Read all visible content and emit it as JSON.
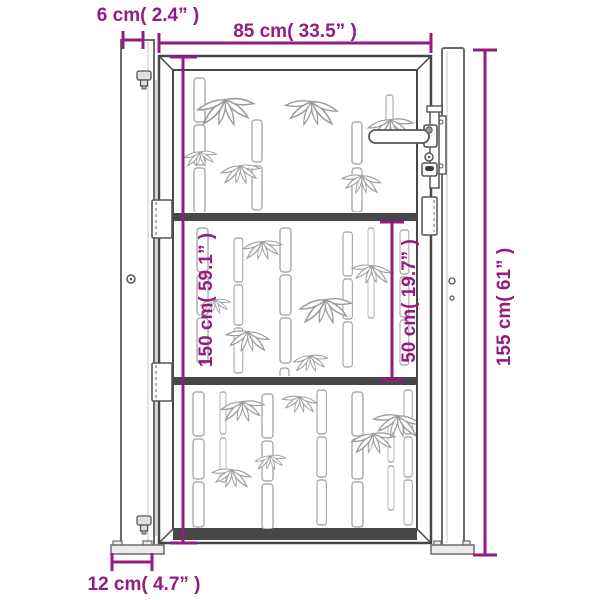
{
  "colors": {
    "accent_magenta": "#951b81",
    "gate_outline": "#474747",
    "post_outline": "#6b6b6b",
    "bamboo_pattern": "#9c9c9c"
  },
  "dimensions": {
    "post_width": {
      "label": "6 cm( 2.4” )",
      "orientation": "horizontal"
    },
    "gate_width": {
      "label": "85 cm( 33.5” )",
      "orientation": "horizontal"
    },
    "gate_height": {
      "label": "150 cm( 59.1” )",
      "orientation": "vertical"
    },
    "mid_section_height": {
      "label": "50 cm( 19.7” )",
      "orientation": "vertical"
    },
    "total_height": {
      "label": "155 cm( 61” )",
      "orientation": "vertical"
    },
    "base_plate_width": {
      "label": "12 cm( 4.7” )",
      "orientation": "horizontal"
    }
  }
}
